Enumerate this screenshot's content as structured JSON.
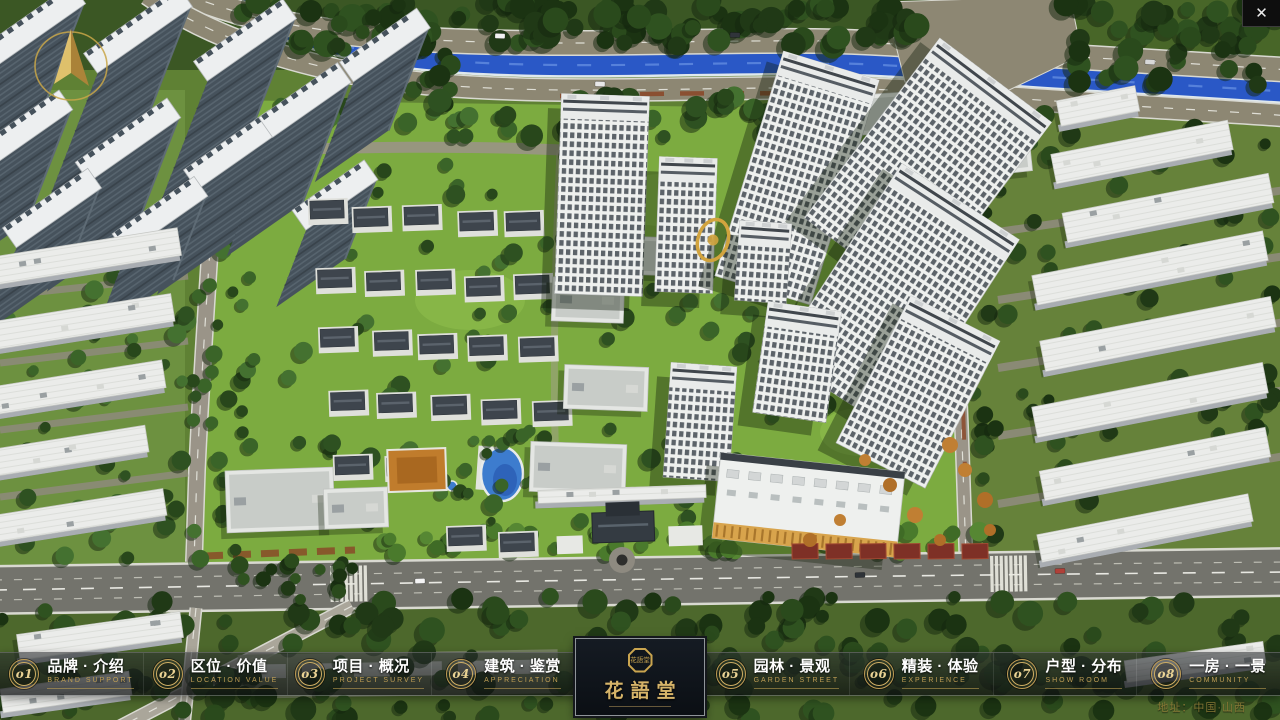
{
  "window": {
    "close_icon": "✕"
  },
  "nav": {
    "items": [
      {
        "num": "o1",
        "title": "品牌 · 介绍",
        "subtitle": "BRAND SUPPORT"
      },
      {
        "num": "o2",
        "title": "区位 · 价值",
        "subtitle": "LOCATION VALUE"
      },
      {
        "num": "o3",
        "title": "项目 · 概况",
        "subtitle": "PROJECT SURVEY"
      },
      {
        "num": "o4",
        "title": "建筑 · 鉴赏",
        "subtitle": "APPRECIATION"
      },
      {
        "num": "o5",
        "title": "园林 · 景观",
        "subtitle": "GARDEN STREET"
      },
      {
        "num": "o6",
        "title": "精装 · 体验",
        "subtitle": "EXPERIENCE"
      },
      {
        "num": "o7",
        "title": "户型 · 分布",
        "subtitle": "SHOW ROOM"
      },
      {
        "num": "o8",
        "title": "一房 · 一景",
        "subtitle": "COMMUNITY"
      }
    ]
  },
  "logo": {
    "seal_text": "花語堂",
    "title": "花語堂"
  },
  "footer": {
    "address": "地址：中国·山西"
  },
  "colors": {
    "accent_gold": "#c9a656",
    "panel_dark": "#10151c",
    "river_blue": "#2a58c6",
    "grass_green": "#7cab40"
  }
}
